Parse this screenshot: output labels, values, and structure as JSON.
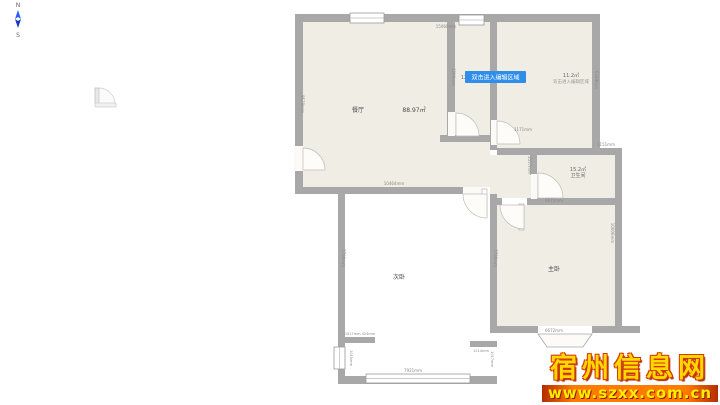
{
  "compass": {
    "north": "N",
    "south": "S"
  },
  "watermark": {
    "title": "宿州信息网",
    "url": "www.szxx.com.cn"
  },
  "tooltip": {
    "text": "双击进入编辑区域"
  },
  "rooms": {
    "dining": {
      "name": "餐厅",
      "area": "88.97㎡"
    },
    "top_right": {
      "area": "11.2㎡",
      "placeholder": "双击进入编辑区域"
    },
    "bathroom": {
      "name": "卫生间",
      "area": "15.2㎡"
    },
    "master": {
      "name": "主卧"
    },
    "second": {
      "name": "次卧"
    },
    "corridor": {
      "area_partial": "12"
    }
  },
  "dims": {
    "top_width": "15060mm",
    "living_left_height": "9570mm",
    "living_bottom_width": "10464mm",
    "corridor_wall": "1290mm",
    "top_right_height": "6349mm",
    "step_width": "1151mm",
    "bath_top": "1171mm",
    "bath_left": "3557mm",
    "bath_bottom": "6672mm",
    "master_right_height": "10006mm",
    "master_bottom": "6672mm",
    "second_left_height": "7700mm",
    "second_right_height": "7700mm",
    "second_bottom": "7921mm",
    "stub_left": "1017mm 424mm",
    "stub_right": "1214mm",
    "stub_right_v": "1017mm",
    "left_window": "1010mm"
  },
  "colors": {
    "wall": "#a8a8a8",
    "floor": "#f0ede4",
    "selection": "#2e8ee9",
    "watermark_yellow": "#ffd800",
    "watermark_red": "#d63a00"
  }
}
